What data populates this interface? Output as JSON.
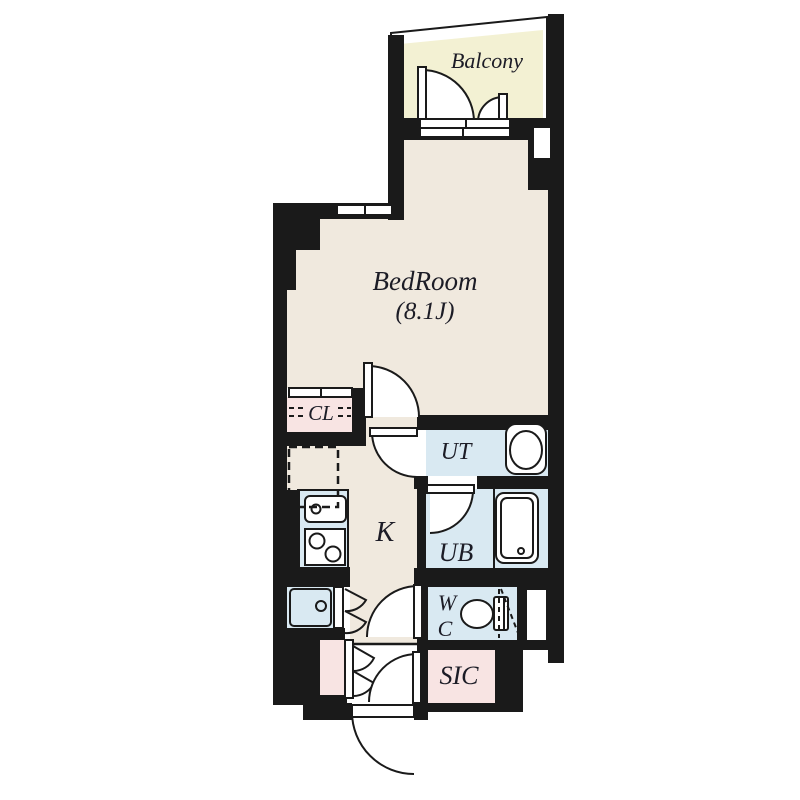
{
  "rooms": {
    "balcony": {
      "label": "Balcony"
    },
    "bedroom": {
      "label": "BedRoom",
      "size": "(8.1J)"
    },
    "closet": {
      "label": "CL"
    },
    "utility": {
      "label": "UT"
    },
    "kitchen": {
      "label": "K"
    },
    "unit_bath": {
      "label": "UB"
    },
    "toilet": {
      "line1": "W",
      "line2": "C"
    },
    "shoe_closet": {
      "label": "SIC"
    }
  },
  "colors": {
    "wall": "#1a1a1a",
    "floor": "#f0e9de",
    "balcony": "#f3f1d3",
    "wet": "#d9e9f2",
    "pink": "#f8e4e3",
    "text": "#1c1c26"
  }
}
